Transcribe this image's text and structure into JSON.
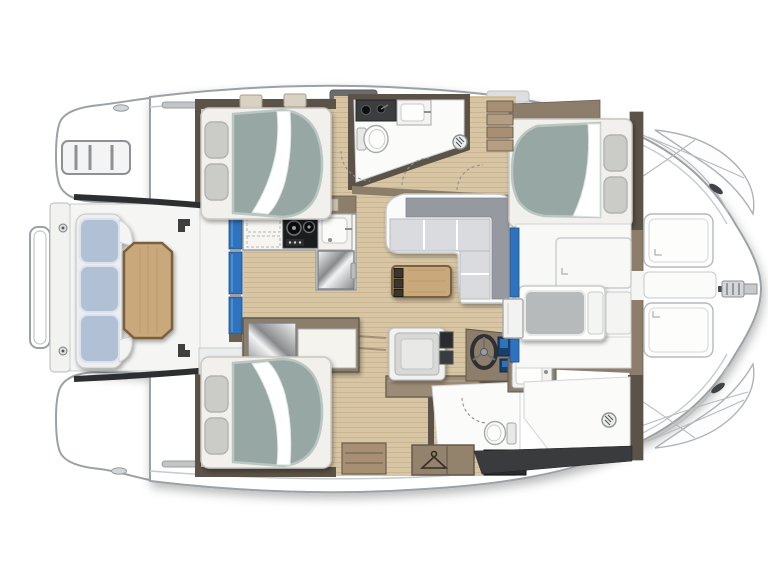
{
  "title": "Catamaran yacht deck and accommodation floor plan, top view with bow to the right",
  "palette": {
    "hull-stroke": "#9ba1a6",
    "deck-white": "#f5f5f3",
    "white-floor": "#fbfbf9",
    "wood": "#d7c5a4",
    "wood-grain": "#b59e78",
    "wall-dark": "#5b5248",
    "wall-mid": "#8c7e6a",
    "trim": "#a68f72",
    "table-wood": "#c9a87b",
    "table-edge": "#7c5f3b",
    "mattress": "#97a8a4",
    "mattress-edge": "#b9c6c2",
    "pillow": "#cbccc8",
    "bench": "#b1c0d4",
    "bench-edge": "#dbe3ee",
    "sofa-seat": "#d9dbde",
    "sofa-back": "#96999f",
    "blue": "#2e73bd",
    "dark": "#2d2e30",
    "stove-dark": "#1b1c1d",
    "metal-light": "#f2f3f3",
    "metal-dark": "#87898c"
  },
  "plan": {
    "orientation": "bow-right",
    "hulls": 2,
    "counts": {
      "double_berths": 3,
      "toilets": 2,
      "showers": 2,
      "helm_wheels": 1
    },
    "aft_deck": [
      "transom-platform-port",
      "transom-platform-starboard",
      "boarding-ladder",
      "stern-rail",
      "cockpit-bench-3-cushions",
      "cockpit-table"
    ],
    "salon": [
      "sliding-glass-door",
      "l-shaped-galley",
      "two-burner-stove",
      "galley-sink",
      "refrigerator",
      "storage-drawers",
      "l-shaped-sofa",
      "coffee-table",
      "nav-desk",
      "helm-wheel",
      "instrument-screens",
      "nav-chair"
    ],
    "top_hull": [
      "double-berth-aft",
      "head-counter",
      "washbasin",
      "toilet",
      "shower-drain",
      "companionway-steps",
      "double-berth-forward"
    ],
    "bottom_hull": [
      "double-berth-aft",
      "mirror-locker",
      "counter",
      "dresser",
      "toilet",
      "washbasin",
      "hanging-wardrobe",
      "utility-appliance",
      "shower-with-drain"
    ],
    "forward_area": [
      "forward-cockpit-seat",
      "deck-hatch-forward-port",
      "deck-hatch-forward-starboard",
      "anchor-fitting",
      "mooring-cleats"
    ]
  }
}
